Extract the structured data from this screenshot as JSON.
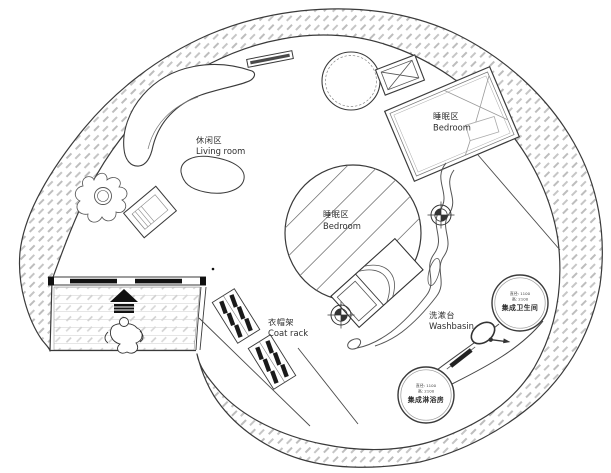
{
  "plan": {
    "regions": {
      "living_room": {
        "zh": "休闲区",
        "en": "Living room"
      },
      "bedroom_upper": {
        "zh": "睡眠区",
        "en": "Bedroom"
      },
      "bedroom_center": {
        "zh": "睡眠区",
        "en": "Bedroom"
      },
      "coat_rack": {
        "zh": "衣帽架",
        "en": "Coat rack"
      },
      "washbasin": {
        "zh": "洗漱台",
        "en": "Washbasin"
      }
    },
    "pods": {
      "bathroom": {
        "name": "集成卫生间",
        "dim_diameter": "直径: 1100",
        "dim_height": "高: 2100"
      },
      "shower": {
        "name": "集成淋浴房",
        "dim_diameter": "直径: 1100",
        "dim_height": "高: 2100"
      }
    },
    "colors": {
      "line": "#3a3a3a",
      "wall_hatch": "#bdbdbd",
      "floor_hatch": "#cfcfcf",
      "ink": "#111111",
      "paper": "#ffffff"
    }
  }
}
